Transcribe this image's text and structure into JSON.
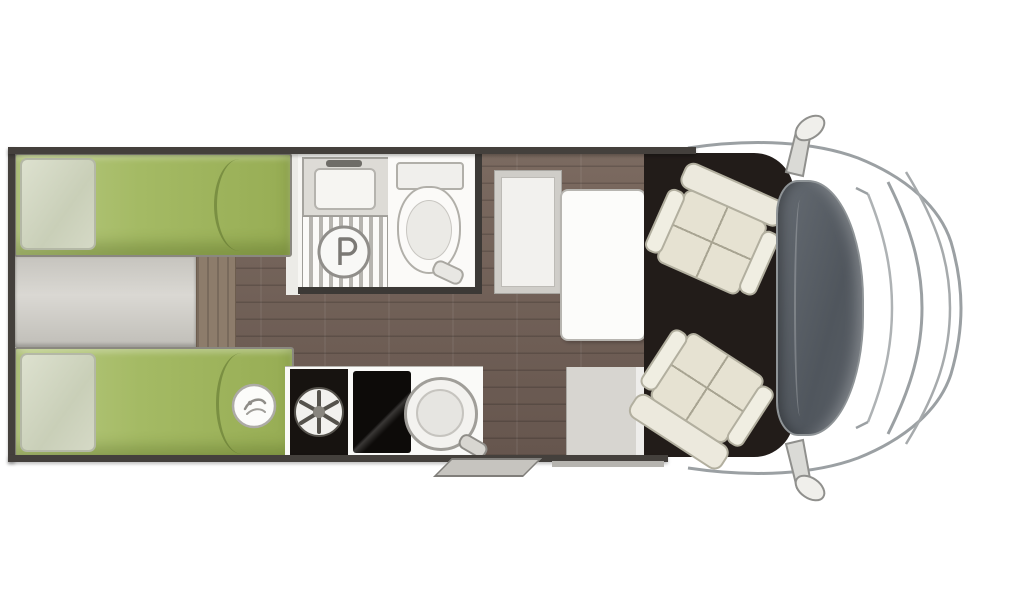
{
  "diagram": {
    "kind": "motorhome floor plan, top view",
    "orientation": "cab and windshield on the right, twin rear beds on the left, entrance door bottom right of habitation area",
    "rooms": [
      {
        "name": "rear-bed-upper",
        "features": [
          "green mattress",
          "pillow at rear wall",
          "duvet fold line"
        ]
      },
      {
        "name": "rear-bed-lower",
        "features": [
          "green mattress",
          "pillow at rear wall",
          "round brand badge"
        ]
      },
      {
        "name": "center-platform",
        "features": [
          "grey step platform between beds",
          "wood access step"
        ]
      },
      {
        "name": "washroom",
        "features": [
          "basin with faucet",
          "slatted shower tray with round drain",
          "toilet with cistern and flush"
        ]
      },
      {
        "name": "kitchen",
        "features": [
          "black appliance with round burner fan",
          "black glass hob",
          "round sink with tap"
        ]
      },
      {
        "name": "dinette",
        "features": [
          "side bench",
          "white table"
        ]
      },
      {
        "name": "entrance",
        "features": [
          "door area",
          "fold-out entry step outside the wall"
        ]
      },
      {
        "name": "cab",
        "features": [
          "dark cab floor",
          "two cream swivel captain seats",
          "windshield",
          "hood outline",
          "two side mirrors"
        ]
      }
    ],
    "icons": [
      "shower-drain-icon",
      "burner-fan-icon",
      "brand-badge-icon"
    ]
  },
  "palette": {
    "background": "#ffffff",
    "wall": "#44403c",
    "wood_floor": "#6e5e55",
    "mattress_green": "#a4ba64",
    "pillow_sage": "#d5d9c6",
    "platform_grey": "#cfcdc7",
    "fixture_white": "#f7f6f3",
    "appliance_black": "#14100d",
    "cab_floor": "#221c19",
    "seat_cream": "#e9e6d8",
    "windshield_slate": "#575d64",
    "outline_grey": "#9ba0a3"
  },
  "text": {}
}
